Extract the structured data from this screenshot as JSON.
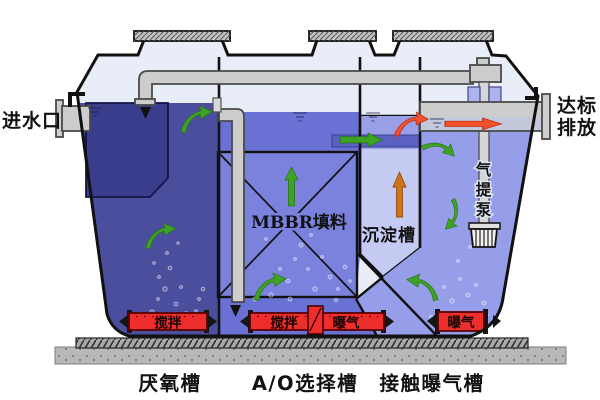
{
  "diagram": {
    "inlet_label": "进水口",
    "outlet_label": [
      "达标",
      "排放"
    ],
    "airlift_pump_label": [
      "气",
      "提",
      "泵"
    ],
    "mbbr_label": "MBBR填料",
    "sedimentation_label": "沉淀槽",
    "tank_labels": [
      "厌氧槽",
      "A/O选择槽",
      "接触曝气槽"
    ],
    "devices": {
      "anaerobic_mixer": "搅拌",
      "ao_mixer": "搅拌",
      "ao_aerator": "曝气",
      "contact_aerator": "曝气"
    }
  },
  "colors": {
    "headspace": "#e9edf7",
    "anaerobic_water": "#4b4e9d",
    "inlet_baffle": "#3a3d8c",
    "ao_water": "#6a71d4",
    "mbbr_box": "#7b82de",
    "sedimentation_water": "#c5caf2",
    "sedimentation_top": "#99a0e8",
    "transfer_channel": "#5a61c0",
    "contact_water": "#969de9",
    "device_red": "#ee2d2d",
    "pipe_gray": "#cdcdcd",
    "arrow_green": "#3ea227",
    "arrow_orange": "#d2711c",
    "arrow_red": "#f4502a",
    "concrete": "#b8b8b8"
  }
}
